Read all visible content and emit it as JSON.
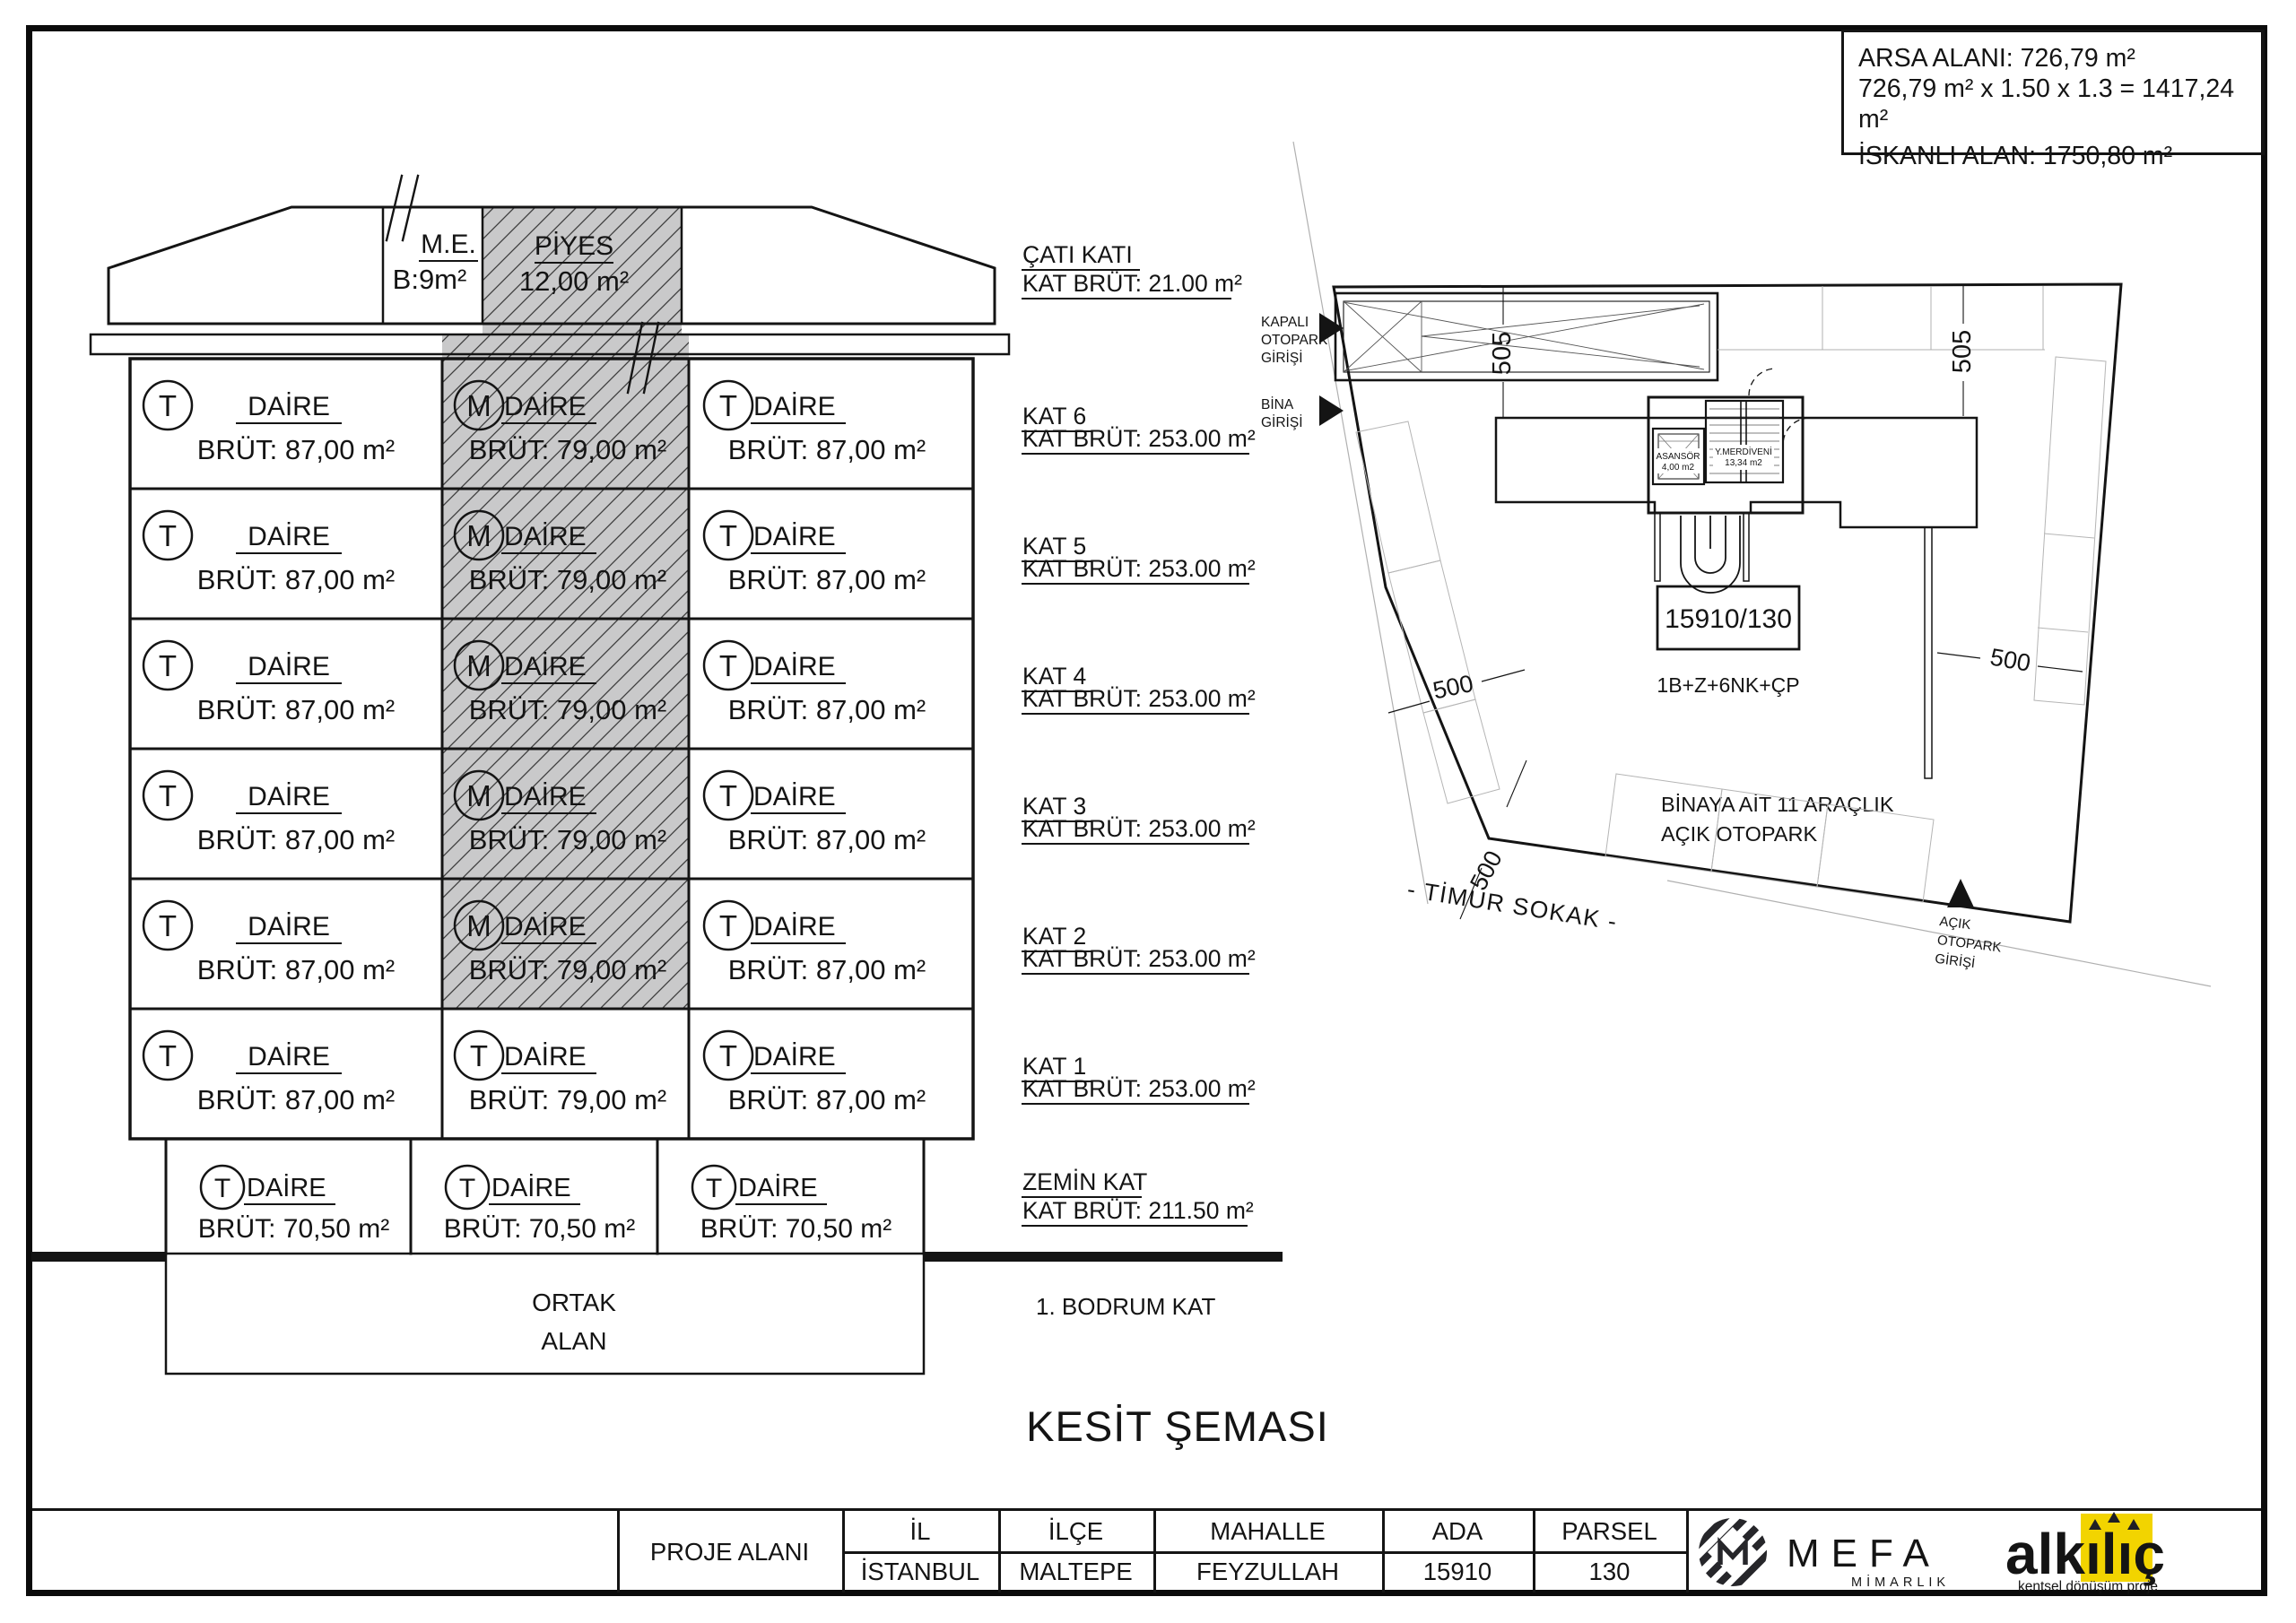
{
  "page": {
    "ink": "#141414",
    "hatch_fill": "#c9c9ca",
    "light_line": "#b0b0b0"
  },
  "info_box": {
    "line1": "ARSA ALANI:  726,79 m²",
    "line2": "726,79 m² x 1.50 x 1.3 = 1417,24 m²",
    "line3": "İSKANLI ALAN:  1750,80 m²"
  },
  "section": {
    "roof": {
      "me": "M.E.",
      "me_area": "B:9m²",
      "piyes": "PİYES",
      "piyes_area": "12,00 m²"
    },
    "cati": {
      "label": "ÇATI KATI",
      "brut": "KAT BRÜT: 21.00 m²"
    },
    "unit_label": "DAİRE",
    "floors": [
      {
        "label": "KAT 6",
        "brut": "KAT BRÜT: 253.00 m²",
        "cells": [
          {
            "letter": "T",
            "area": "BRÜT: 87,00 m²"
          },
          {
            "letter": "M",
            "area": "BRÜT: 79,00 m²"
          },
          {
            "letter": "T",
            "area": "BRÜT: 87,00 m²"
          }
        ]
      },
      {
        "label": "KAT 5",
        "brut": "KAT BRÜT: 253.00 m²",
        "cells": [
          {
            "letter": "T",
            "area": "BRÜT: 87,00 m²"
          },
          {
            "letter": "M",
            "area": "BRÜT: 79,00 m²"
          },
          {
            "letter": "T",
            "area": "BRÜT: 87,00 m²"
          }
        ]
      },
      {
        "label": "KAT 4",
        "brut": "KAT BRÜT: 253.00 m²",
        "cells": [
          {
            "letter": "T",
            "area": "BRÜT: 87,00 m²"
          },
          {
            "letter": "M",
            "area": "BRÜT: 79,00 m²"
          },
          {
            "letter": "T",
            "area": "BRÜT: 87,00 m²"
          }
        ]
      },
      {
        "label": "KAT 3",
        "brut": "KAT BRÜT: 253.00 m²",
        "cells": [
          {
            "letter": "T",
            "area": "BRÜT: 87,00 m²"
          },
          {
            "letter": "M",
            "area": "BRÜT: 79,00 m²"
          },
          {
            "letter": "T",
            "area": "BRÜT: 87,00 m²"
          }
        ]
      },
      {
        "label": "KAT 2",
        "brut": "KAT BRÜT: 253.00 m²",
        "cells": [
          {
            "letter": "T",
            "area": "BRÜT: 87,00 m²"
          },
          {
            "letter": "M",
            "area": "BRÜT: 79,00 m²"
          },
          {
            "letter": "T",
            "area": "BRÜT: 87,00 m²"
          }
        ]
      },
      {
        "label": "KAT 1",
        "brut": "KAT BRÜT: 253.00 m²",
        "cells": [
          {
            "letter": "T",
            "area": "BRÜT: 87,00 m²"
          },
          {
            "letter": "T",
            "area": "BRÜT: 79,00 m²"
          },
          {
            "letter": "T",
            "area": "BRÜT: 87,00 m²"
          }
        ]
      }
    ],
    "hatched_rows": [
      0,
      1,
      2,
      3,
      4
    ],
    "zemin": {
      "label": "ZEMİN KAT",
      "brut": "KAT BRÜT: 211.50 m²",
      "cells": [
        {
          "letter": "T",
          "area": "BRÜT: 70,50 m²"
        },
        {
          "letter": "T",
          "area": "BRÜT: 70,50 m²"
        },
        {
          "letter": "T",
          "area": "BRÜT: 70,50 m²"
        }
      ]
    },
    "ortak": [
      "ORTAK",
      "ALAN"
    ],
    "bodrum": "1. BODRUM KAT",
    "sheet_title": "KESİT ŞEMASI"
  },
  "site_plan": {
    "parcel_no": "15910/130",
    "building_code": "1B+Z+6NK+ÇP",
    "open_parking_line1": "BİNAYA AİT 11 ARAÇLIK",
    "open_parking_line2": "AÇIK OTOPARK",
    "street": "- TİMUR SOKAK -",
    "dim_505": "505",
    "dim_500": "500",
    "entr_kapali": [
      "KAPALI",
      "OTOPARK",
      "GİRİŞİ"
    ],
    "entr_bina": [
      "BİNA",
      "GİRİŞİ"
    ],
    "entr_acik": [
      "AÇIK",
      "OTOPARK",
      "GİRİŞİ"
    ],
    "asansor": [
      "ASANSÖR",
      "4,00 m2"
    ],
    "merdiven": [
      "Y.MERDİVENİ",
      "13,34 m2"
    ]
  },
  "title_block": {
    "project_area_label": "PROJE ALANI",
    "columns": [
      {
        "header": "İL",
        "value": "İSTANBUL"
      },
      {
        "header": "İLÇE",
        "value": "MALTEPE"
      },
      {
        "header": "MAHALLE",
        "value": "FEYZULLAH"
      },
      {
        "header": "ADA",
        "value": "15910"
      },
      {
        "header": "PARSEL",
        "value": "130"
      }
    ],
    "mefa": {
      "name": "MEFA",
      "tagline": "MİMARLIK"
    },
    "alkilic": {
      "name": "alkılıç",
      "tagline": "kentsel dönüşüm proje",
      "accent": "#f2d400"
    }
  }
}
